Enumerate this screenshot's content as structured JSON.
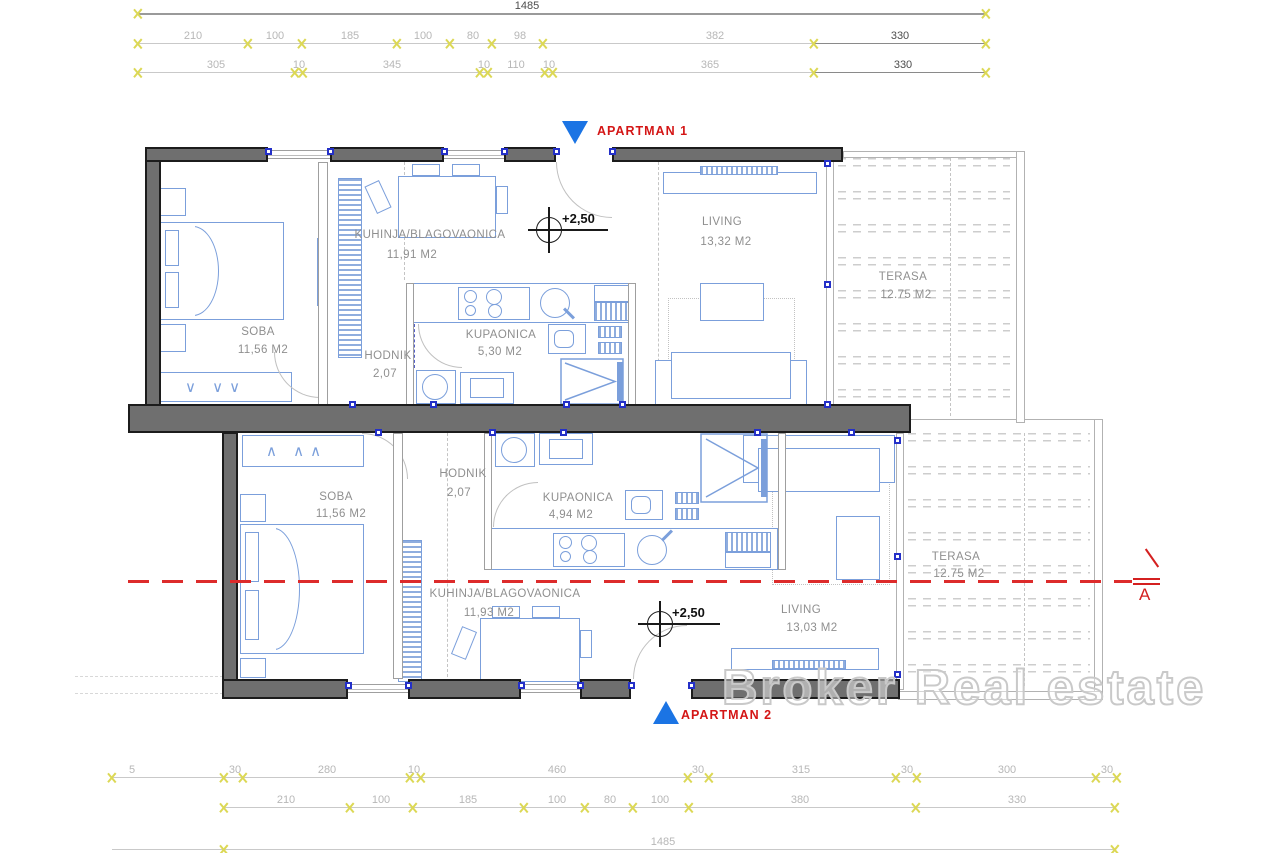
{
  "dims": {
    "top_total": "1485",
    "top_row1": [
      "210",
      "100",
      "185",
      "100",
      "80",
      "98",
      "382",
      "330"
    ],
    "top_row2": [
      "305",
      "10",
      "345",
      "10",
      "110",
      "10",
      "365",
      "330"
    ],
    "bottom_row1": [
      "5",
      "30",
      "280",
      "10",
      "460",
      "30",
      "315",
      "30",
      "300",
      "30"
    ],
    "bottom_row2": [
      "210",
      "100",
      "185",
      "100",
      "80",
      "100",
      "380",
      "330"
    ],
    "bottom_total": "1485"
  },
  "apartments": {
    "a1": {
      "marker": "APARTMAN 1",
      "level": "+2,50",
      "soba_name": "SOBA",
      "soba_area": "11,56 M2",
      "kuhinja_name": "KUHINJA/BLAGOVAONICA",
      "kuhinja_area": "11,91 M2",
      "hodnik_name": "HODNIK",
      "hodnik_area": "2,07",
      "kupaonica_name": "KUPAONICA",
      "kupaonica_area": "5,30 M2",
      "living_name": "LIVING",
      "living_area": "13,32 M2",
      "terasa_name": "TERASA",
      "terasa_area": "12.75 M2"
    },
    "a2": {
      "marker": "APARTMAN 2",
      "level": "+2,50",
      "soba_name": "SOBA",
      "soba_area": "11,56 M2",
      "hodnik_name": "HODNIK",
      "hodnik_area": "2,07",
      "kupaonica_name": "KUPAONICA",
      "kupaonica_area": "4,94 M2",
      "kuhinja_name": "KUHINJA/BLAGOVAONICA",
      "kuhinja_area": "11,93 M2",
      "living_name": "LIVING",
      "living_area": "13,03 M2",
      "terasa_name": "TERASA",
      "terasa_area": "12.75 M2"
    }
  },
  "section": {
    "label": "A"
  },
  "watermark": "Broker Real estate",
  "symbols": {
    "hangers_down": "∨ ∨∨",
    "hangers_up": "∧ ∧∧"
  },
  "colors": {
    "wall": "#6f6f6f",
    "furniture_blue": "#7b9fdb",
    "marker_blue": "#1b74e4",
    "annotation_red": "#d42020",
    "dim_light": "#b7b7b7",
    "dim_dark": "#4d4d4d",
    "tick_yellow": "#dcd855"
  }
}
